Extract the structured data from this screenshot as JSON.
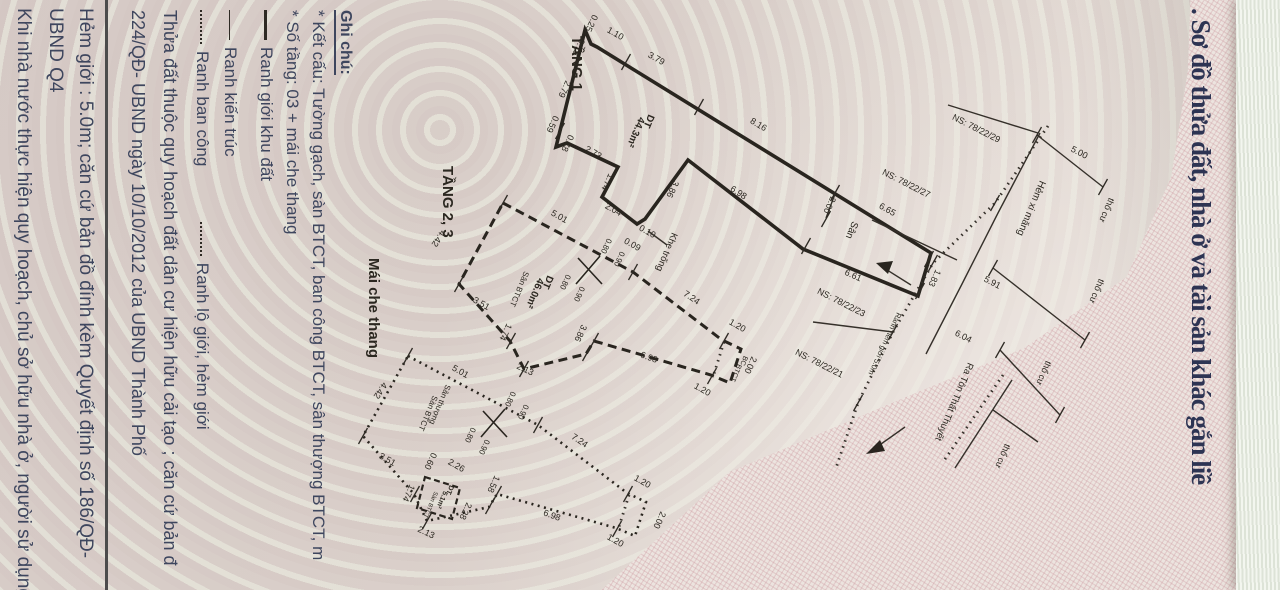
{
  "title": ". Sơ đồ thửa đất, nhà ở và tài sản khác gắn liề",
  "legend": {
    "heading": "Ghi chú:",
    "line_ketcau": "* Kết cấu: Tường gạch, sàn BTCT, ban công BTCT, sân thượng BTCT, m",
    "line_sotang": "* Số tầng: 03 + mái che thang",
    "items": [
      {
        "symbol": "thick",
        "label": "Ranh giới khu đất"
      },
      {
        "symbol": "thin",
        "label": "Ranh kiến trúc"
      },
      {
        "symbol": "dotted",
        "label": "Ranh ban công"
      },
      {
        "symbol": "dotted",
        "label": "Ranh lộ giới, hẻm giới"
      }
    ]
  },
  "notes": {
    "quyhoach": "Thửa đất thuộc quy hoạch đất dân cư hiện hữu cải tạo ; căn cứ bản đ",
    "quyetdinh": "224/QĐ- UBND ngày 10/10/2012 của UBND Thành Phố",
    "hemgioi": "Hẻm giới : 5.0m;  căn cứ bản đồ đính kèm Quyết định số 186/QĐ-",
    "ubnd": "UBND Q4",
    "khinhanuoc": "Khi nhà nước thực hiện quy hoạch, chủ sở hữu nhà ở, người sử dụng"
  },
  "colors": {
    "ink": "#29251f",
    "title": "#2d3453",
    "legend_text": "#3e465e",
    "paper": "#d7cbc6"
  },
  "annotations": [
    {
      "t": "TẦNG 1",
      "x": 572,
      "y": 36,
      "r": 90,
      "s": 15,
      "b": 1,
      "a": "s"
    },
    {
      "t": "0.25",
      "x": 589,
      "y": 22,
      "r": 115,
      "s": 9
    },
    {
      "t": "1.10",
      "x": 614,
      "y": 36,
      "r": 29,
      "s": 9
    },
    {
      "t": "3.79",
      "x": 655,
      "y": 61,
      "r": 29,
      "s": 9
    },
    {
      "t": "8.16",
      "x": 757,
      "y": 127,
      "r": 31,
      "s": 9
    },
    {
      "t": "6.65",
      "x": 886,
      "y": 212,
      "r": 29,
      "s": 9
    },
    {
      "t": "0.79",
      "x": 576,
      "y": 46,
      "r": 115,
      "s": 9
    },
    {
      "t": "2.79",
      "x": 562,
      "y": 88,
      "r": 115,
      "s": 9
    },
    {
      "t": "0.59",
      "x": 550,
      "y": 123,
      "r": 115,
      "s": 9
    },
    {
      "t": "0.78",
      "x": 565,
      "y": 142,
      "r": 115,
      "s": 9
    },
    {
      "t": "2.73",
      "x": 592,
      "y": 155,
      "r": 29,
      "s": 9
    },
    {
      "t": "1.74",
      "x": 605,
      "y": 181,
      "r": 115,
      "s": 9
    },
    {
      "t": "2.04",
      "x": 612,
      "y": 212,
      "r": 29,
      "s": 9
    },
    {
      "t": "0.10",
      "x": 646,
      "y": 234,
      "r": 29,
      "s": 9
    },
    {
      "t": "0.09",
      "x": 631,
      "y": 247,
      "r": 29,
      "s": 9
    },
    {
      "t": "3.86",
      "x": 670,
      "y": 188,
      "r": 115,
      "s": 9
    },
    {
      "t": "6.98",
      "x": 737,
      "y": 195,
      "r": 33,
      "s": 9
    },
    {
      "t": "2.00",
      "x": 827,
      "y": 204,
      "r": 115,
      "s": 9
    },
    {
      "t": "Sân",
      "x": 849,
      "y": 229,
      "r": 113,
      "s": 10
    },
    {
      "t": "6.61",
      "x": 852,
      "y": 278,
      "r": 24,
      "s": 9
    },
    {
      "t": "1.83",
      "x": 932,
      "y": 277,
      "r": 115,
      "s": 9
    },
    {
      "t": "Khe trống",
      "x": 672,
      "y": 232,
      "r": 113,
      "s": 9.5,
      "a": "s"
    },
    {
      "t": "DT",
      "x": 646,
      "y": 120,
      "r": 113,
      "s": 10,
      "b": 1
    },
    {
      "t": "44.3m²",
      "x": 633,
      "y": 131,
      "r": 113,
      "s": 10,
      "b": 1
    },
    {
      "t": "TẦNG 2, 3",
      "x": 443,
      "y": 166,
      "r": 90,
      "s": 15,
      "b": 1,
      "a": "s"
    },
    {
      "t": "5.01",
      "x": 558,
      "y": 219,
      "r": 29,
      "s": 9
    },
    {
      "t": "7.24",
      "x": 690,
      "y": 300,
      "r": 34,
      "s": 9
    },
    {
      "t": "1.20",
      "x": 736,
      "y": 328,
      "r": 29,
      "s": 9
    },
    {
      "t": "2.00",
      "x": 748,
      "y": 364,
      "r": 115,
      "s": 9
    },
    {
      "t": "1.20",
      "x": 701,
      "y": 392,
      "r": 29,
      "s": 9
    },
    {
      "t": "6.98",
      "x": 648,
      "y": 360,
      "r": 20,
      "s": 9
    },
    {
      "t": "3.86",
      "x": 578,
      "y": 332,
      "r": 115,
      "s": 9
    },
    {
      "t": "2.13",
      "x": 524,
      "y": 372,
      "r": 25,
      "s": 9
    },
    {
      "t": "1.74",
      "x": 503,
      "y": 331,
      "r": 115,
      "s": 9
    },
    {
      "t": "3.51",
      "x": 480,
      "y": 306,
      "r": 29,
      "s": 9
    },
    {
      "t": "4.42",
      "x": 436,
      "y": 237,
      "r": 123,
      "s": 9
    },
    {
      "t": "Sân BTCT",
      "x": 517,
      "y": 288,
      "r": 113,
      "s": 8
    },
    {
      "t": "DT",
      "x": 545,
      "y": 281,
      "r": 113,
      "s": 10,
      "b": 1
    },
    {
      "t": "46.0m²",
      "x": 532,
      "y": 292,
      "r": 113,
      "s": 10,
      "b": 1
    },
    {
      "t": "BC",
      "x": 742,
      "y": 360,
      "r": 113,
      "s": 7
    },
    {
      "t": "BTCT",
      "x": 734,
      "y": 372,
      "r": 113,
      "s": 7
    },
    {
      "t": "0.80",
      "x": 604,
      "y": 245,
      "r": 115,
      "s": 8
    },
    {
      "t": "0.90",
      "x": 617,
      "y": 258,
      "r": 115,
      "s": 8
    },
    {
      "t": "0.80",
      "x": 563,
      "y": 281,
      "r": 115,
      "s": 8
    },
    {
      "t": "0.90",
      "x": 577,
      "y": 293,
      "r": 115,
      "s": 8
    },
    {
      "t": "Mái che thang",
      "x": 369,
      "y": 258,
      "r": 90,
      "s": 15,
      "b": 1,
      "a": "s"
    },
    {
      "t": "5.01",
      "x": 459,
      "y": 374,
      "r": 29,
      "s": 9
    },
    {
      "t": "4.42",
      "x": 378,
      "y": 389,
      "r": 123,
      "s": 9
    },
    {
      "t": "3.51",
      "x": 386,
      "y": 462,
      "r": 29,
      "s": 9
    },
    {
      "t": "1.74",
      "x": 406,
      "y": 492,
      "r": 115,
      "s": 9
    },
    {
      "t": "2.13",
      "x": 425,
      "y": 535,
      "r": 25,
      "s": 9
    },
    {
      "t": "7.24",
      "x": 578,
      "y": 443,
      "r": 34,
      "s": 9
    },
    {
      "t": "6.98",
      "x": 551,
      "y": 518,
      "r": 20,
      "s": 9
    },
    {
      "t": "1.20",
      "x": 641,
      "y": 484,
      "r": 29,
      "s": 9
    },
    {
      "t": "2.00",
      "x": 657,
      "y": 519,
      "r": 115,
      "s": 9
    },
    {
      "t": "1.20",
      "x": 614,
      "y": 543,
      "r": 29,
      "s": 9
    },
    {
      "t": "2.26",
      "x": 455,
      "y": 468,
      "r": 29,
      "s": 9
    },
    {
      "t": "0.60",
      "x": 428,
      "y": 460,
      "r": 115,
      "s": 9
    },
    {
      "t": "1.58",
      "x": 491,
      "y": 483,
      "r": 115,
      "s": 9
    },
    {
      "t": "2.28",
      "x": 463,
      "y": 510,
      "r": 115,
      "s": 9
    },
    {
      "t": "Sân thượng",
      "x": 446,
      "y": 384,
      "r": 113,
      "s": 8,
      "a": "s"
    },
    {
      "t": "Sàn BTCT",
      "x": 433,
      "y": 395,
      "r": 113,
      "s": 8,
      "a": "s"
    },
    {
      "t": "DT",
      "x": 448,
      "y": 489,
      "r": 113,
      "s": 7,
      "b": 1
    },
    {
      "t": "5.1m²",
      "x": 440,
      "y": 499,
      "r": 113,
      "s": 7,
      "b": 1
    },
    {
      "t": "Sàn BTCT",
      "x": 429,
      "y": 504,
      "r": 113,
      "s": 6
    },
    {
      "t": "0.80",
      "x": 508,
      "y": 398,
      "r": 115,
      "s": 8
    },
    {
      "t": "0.90",
      "x": 521,
      "y": 411,
      "r": 115,
      "s": 8
    },
    {
      "t": "0.80",
      "x": 468,
      "y": 434,
      "r": 115,
      "s": 8
    },
    {
      "t": "0.90",
      "x": 482,
      "y": 446,
      "r": 115,
      "s": 8
    },
    {
      "t": "NS: 78/22/29",
      "x": 975,
      "y": 131,
      "r": 27,
      "s": 9
    },
    {
      "t": "NS: 78/22/27",
      "x": 905,
      "y": 186,
      "r": 27,
      "s": 9
    },
    {
      "t": "NS: 78/22/23",
      "x": 840,
      "y": 305,
      "r": 27,
      "s": 9
    },
    {
      "t": "NS: 78/22/21",
      "x": 818,
      "y": 366,
      "r": 27,
      "s": 9
    },
    {
      "t": "5.00",
      "x": 1078,
      "y": 155,
      "r": 27,
      "s": 9
    },
    {
      "t": "5.91",
      "x": 991,
      "y": 285,
      "r": 27,
      "s": 9
    },
    {
      "t": "6.04",
      "x": 962,
      "y": 339,
      "r": 27,
      "s": 9
    },
    {
      "t": "Hẻm xi măng",
      "x": 1040,
      "y": 180,
      "r": 113,
      "s": 10,
      "a": "s"
    },
    {
      "t": "thổ cư",
      "x": 1104,
      "y": 209,
      "r": 113,
      "s": 9
    },
    {
      "t": "thổ cư",
      "x": 1094,
      "y": 290,
      "r": 113,
      "s": 9
    },
    {
      "t": "thổ cư",
      "x": 1041,
      "y": 372,
      "r": 113,
      "s": 9
    },
    {
      "t": "thổ cư",
      "x": 1000,
      "y": 455,
      "r": 113,
      "s": 9
    },
    {
      "t": "Ra Tôn Thất Thuyết",
      "x": 968,
      "y": 362,
      "r": 113,
      "s": 9.5,
      "a": "s"
    },
    {
      "t": "Ranh hẻm giới 5.0m",
      "x": 897,
      "y": 312,
      "r": 115,
      "s": 7.5,
      "a": "s"
    }
  ],
  "ticks": [
    [
      626,
      62
    ],
    [
      699,
      107
    ],
    [
      835,
      193
    ],
    [
      826,
      219
    ],
    [
      929,
      259
    ],
    [
      920,
      291
    ],
    [
      806,
      246
    ],
    [
      560,
      131
    ],
    [
      503,
      203
    ],
    [
      633,
      272
    ],
    [
      724,
      341
    ],
    [
      712,
      376
    ],
    [
      594,
      341
    ],
    [
      587,
      353
    ],
    [
      524,
      369
    ],
    [
      511,
      341
    ],
    [
      459,
      284
    ],
    [
      408,
      356
    ],
    [
      538,
      425
    ],
    [
      628,
      494
    ],
    [
      617,
      529
    ],
    [
      497,
      494
    ],
    [
      490,
      506
    ],
    [
      427,
      521
    ],
    [
      415,
      494
    ],
    [
      363,
      436
    ],
    [
      1037,
      135
    ],
    [
      1103,
      187
    ],
    [
      993,
      268
    ],
    [
      1085,
      340
    ],
    [
      995,
      203
    ],
    [
      933,
      263
    ],
    [
      893,
      332
    ],
    [
      858,
      403
    ],
    [
      1000,
      350
    ],
    [
      1060,
      415
    ]
  ]
}
